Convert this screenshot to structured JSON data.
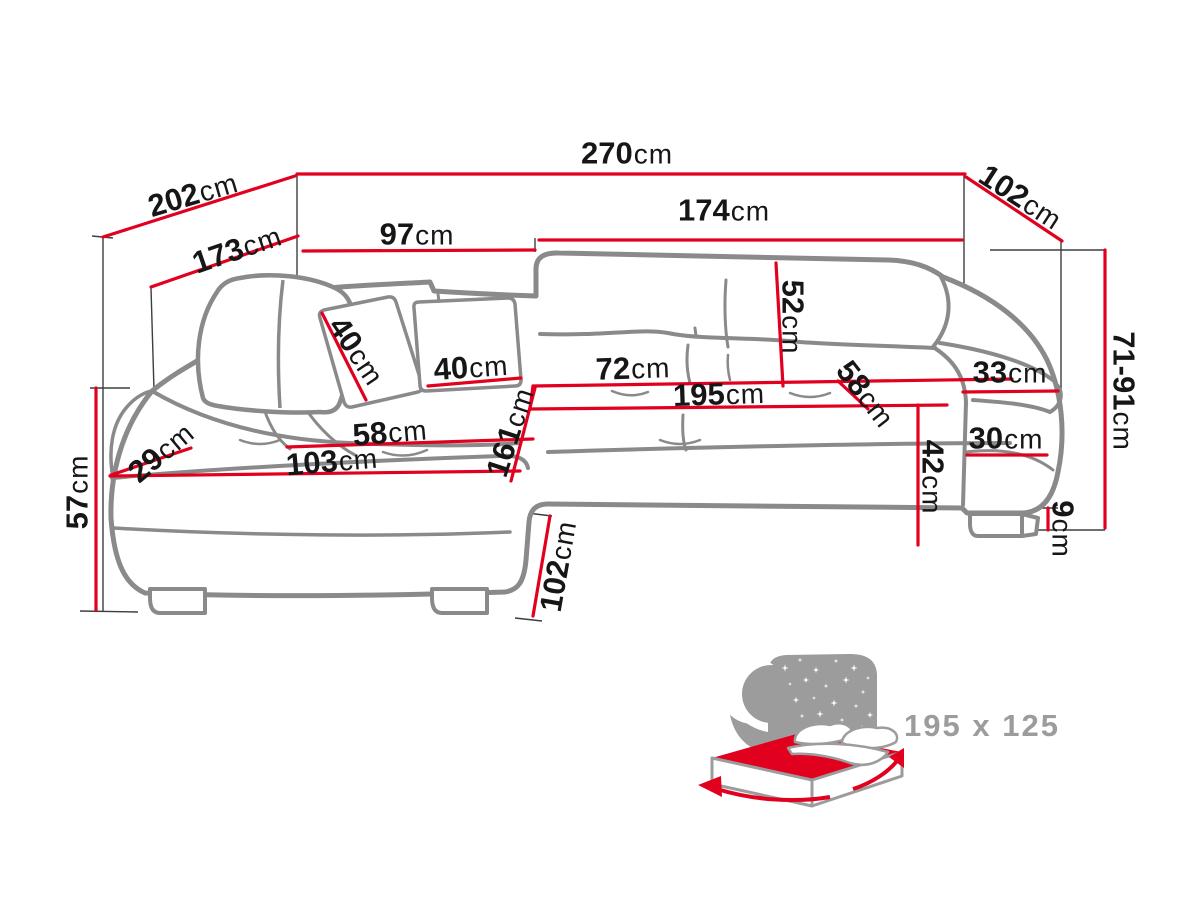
{
  "diagram": {
    "title": "corner-sofa-dimension-diagram",
    "colors": {
      "dimension_red": "#e2001f",
      "sofa_outline_gray": "#8a8a8a",
      "extension_line_gray": "#3e3e3e",
      "label_text": "#161616",
      "icon_gray": "#9c9c9c",
      "bed_mattress_red": "#e2001f"
    },
    "labels": {
      "w202": {
        "value": "202",
        "unit": "cm"
      },
      "w270": {
        "value": "270",
        "unit": "cm"
      },
      "w102_top": {
        "value": "102",
        "unit": "cm"
      },
      "w173": {
        "value": "173",
        "unit": "cm"
      },
      "w97": {
        "value": "97",
        "unit": "cm"
      },
      "w174": {
        "value": "174",
        "unit": "cm"
      },
      "h52": {
        "value": "52",
        "unit": "cm"
      },
      "p40_left": {
        "value": "40",
        "unit": "cm"
      },
      "p40_right": {
        "value": "40",
        "unit": "cm"
      },
      "w72": {
        "value": "72",
        "unit": "cm"
      },
      "w195": {
        "value": "195",
        "unit": "cm"
      },
      "d58_right": {
        "value": "58",
        "unit": "cm"
      },
      "w33": {
        "value": "33",
        "unit": "cm"
      },
      "h71_91": {
        "value": "71-91",
        "unit": "cm"
      },
      "d29": {
        "value": "29",
        "unit": "cm"
      },
      "d58_left": {
        "value": "58",
        "unit": "cm"
      },
      "w103": {
        "value": "103",
        "unit": "cm"
      },
      "d161": {
        "value": "161",
        "unit": "cm"
      },
      "w30": {
        "value": "30",
        "unit": "cm"
      },
      "h42": {
        "value": "42",
        "unit": "cm"
      },
      "h57": {
        "value": "57",
        "unit": "cm"
      },
      "h9": {
        "value": "9",
        "unit": "cm"
      },
      "d102_bottom": {
        "value": "102",
        "unit": "cm"
      }
    },
    "sleeping_function": {
      "bed_size": "195 x 125"
    }
  }
}
